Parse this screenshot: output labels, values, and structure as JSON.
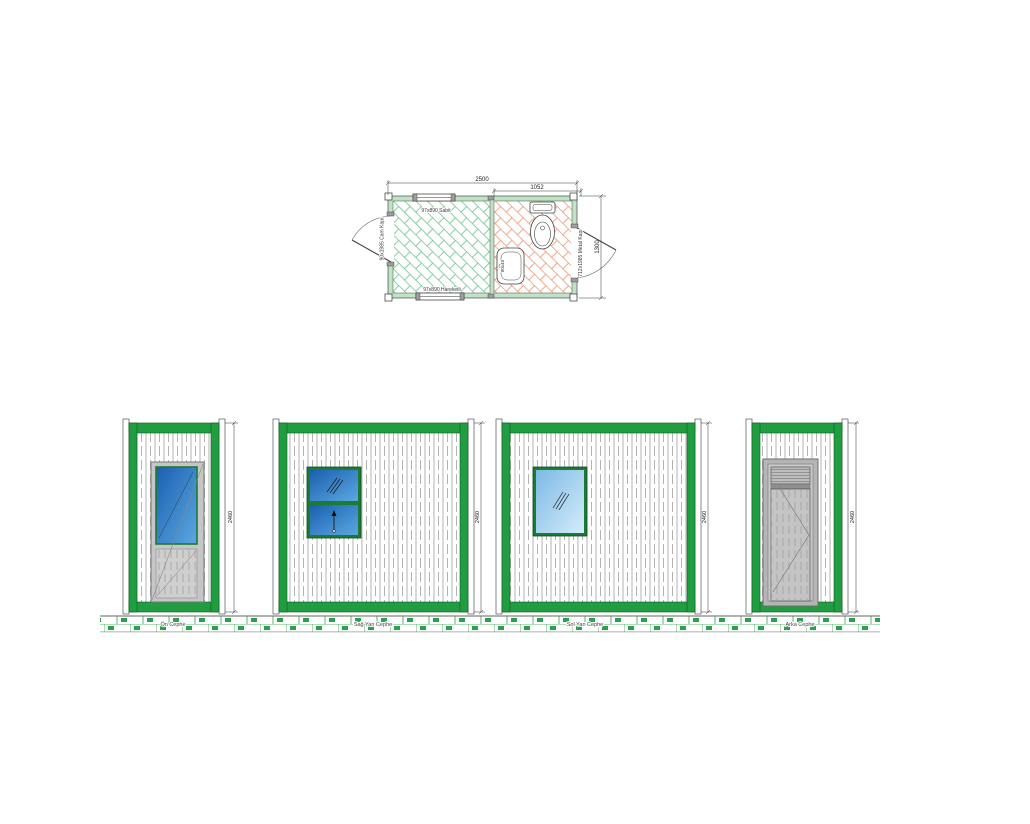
{
  "drawing": {
    "title": "Prefab cabin / container WC technical drawing",
    "plan": {
      "dim_total": "2500",
      "dim_partial": "1052",
      "dim_side": "1300",
      "label_window_top": "97x890 Sabit",
      "label_window_bottom": "97x890 Hareketli",
      "label_door_left": "90x1985 Cam Kapı",
      "label_door_right": "712x1985 Metal Kapı",
      "label_sink": "80x40"
    },
    "elevations": [
      {
        "caption": "Ön Cephe",
        "height_dim": "2460"
      },
      {
        "caption": "Sağ Yan Cephe",
        "height_dim": "2460"
      },
      {
        "caption": "Sol Yan Cephe",
        "height_dim": "2460"
      },
      {
        "caption": "Arka Cephe",
        "height_dim": "2460"
      }
    ],
    "colors": {
      "frame_green": "#1f9d40",
      "frame_green_dark": "#0e5c22",
      "window_frame_green": "#1b7a34",
      "plan_wall_mint": "#bfe3c4",
      "tile_green": "#6cc289",
      "tile_orange": "#eb9472",
      "glass_blue_dark": "#1a5fb0",
      "glass_blue_light": "#5ba8e0",
      "glass_pale": "#7cb9e4",
      "door_gray": "#c6c6c6",
      "ground_brick_green": "#2ba24a",
      "line_dark": "#333333"
    }
  }
}
